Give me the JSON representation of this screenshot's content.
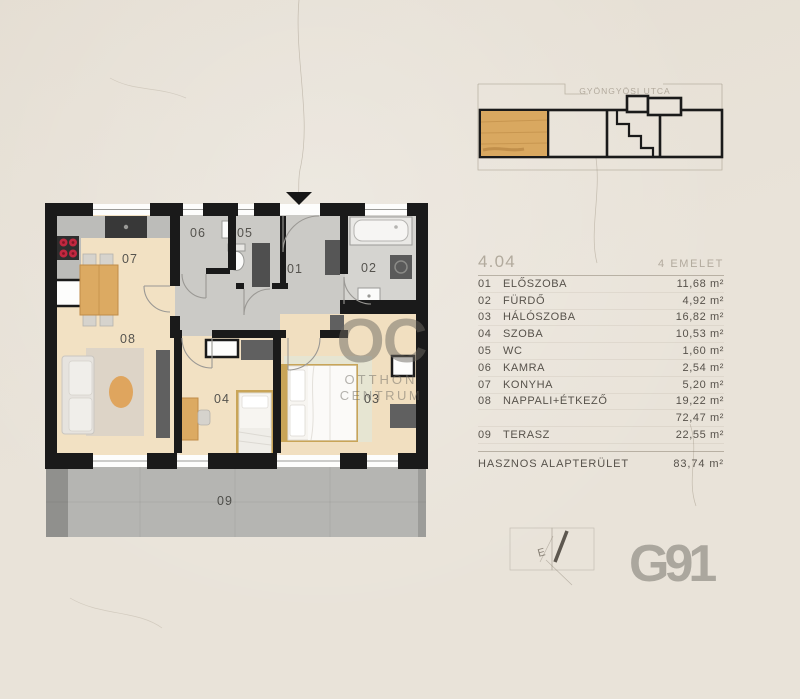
{
  "site_plan": {
    "street_label": "GYÖNGYÖSI UTCA"
  },
  "unit": {
    "number": "4.04",
    "floor": "4 EMELET",
    "rooms": [
      {
        "num": "01",
        "name": "ELŐSZOBA",
        "area": "11,68 m²"
      },
      {
        "num": "02",
        "name": "FÜRDŐ",
        "area": "4,92 m²"
      },
      {
        "num": "03",
        "name": "HÁLÓSZOBA",
        "area": "16,82 m²"
      },
      {
        "num": "04",
        "name": "SZOBA",
        "area": "10,53 m²"
      },
      {
        "num": "05",
        "name": "WC",
        "area": "1,60 m²"
      },
      {
        "num": "06",
        "name": "KAMRA",
        "area": "2,54 m²"
      },
      {
        "num": "07",
        "name": "KONYHA",
        "area": "5,20 m²"
      },
      {
        "num": "08",
        "name": "NAPPALI+ÉTKEZŐ",
        "area": "19,22 m²"
      }
    ],
    "subtotal_area": "72,47 m²",
    "terrace": {
      "num": "09",
      "name": "TERASZ",
      "area": "22,55 m²"
    },
    "total_label": "HASZNOS ALAPTERÜLET",
    "total_area": "83,74 m²"
  },
  "plan": {
    "labels": {
      "r01": "01",
      "r02": "02",
      "r03": "03",
      "r04": "04",
      "r05": "05",
      "r06": "06",
      "r07": "07",
      "r08": "08",
      "r09": "09"
    }
  },
  "watermark": {
    "initials": "OC",
    "line1": "OTTHON",
    "line2": "CENTRUM"
  },
  "brand": {
    "logo": "G91"
  },
  "stamp": {
    "letter": "E"
  },
  "colors": {
    "background": "#e9e3d9",
    "wall": "#1a1a1a",
    "wood_floor": "#f2e1c3",
    "gray_floor": "#cbcac6",
    "terrace_gray": "#b5b5b2",
    "highlight_wood": "#d9a860",
    "table_text": "#57524b",
    "muted_text": "#b2aa9d",
    "logo_gray": "#aba79e",
    "burner_red": "#c22840"
  }
}
